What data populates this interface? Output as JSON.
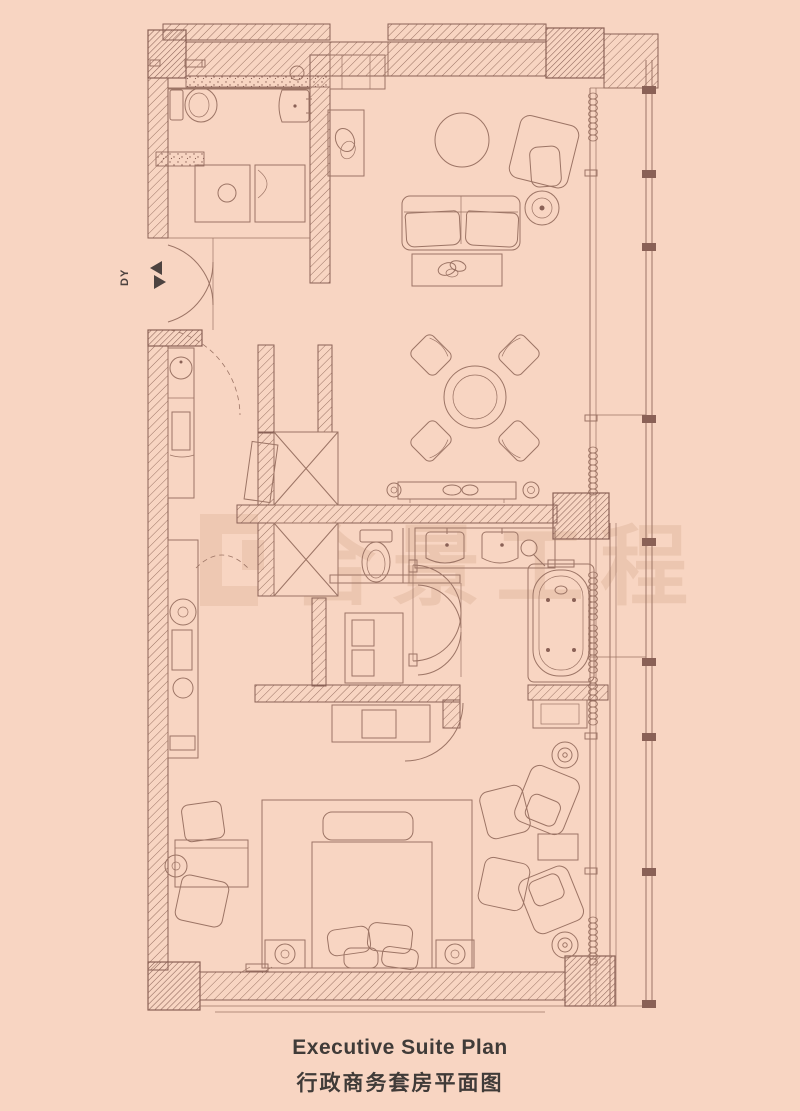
{
  "theme": {
    "background": "#f8d5c2",
    "line_color": "#8a6156",
    "hatch_color": "#9a7263",
    "title_color": "#403b38",
    "watermark_color": "#d8ac90"
  },
  "title": {
    "en": "Executive Suite Plan",
    "zh": "行政商务套房平面图"
  },
  "plan": {
    "entry_label": "DY",
    "watermark_text": "合景工程"
  }
}
